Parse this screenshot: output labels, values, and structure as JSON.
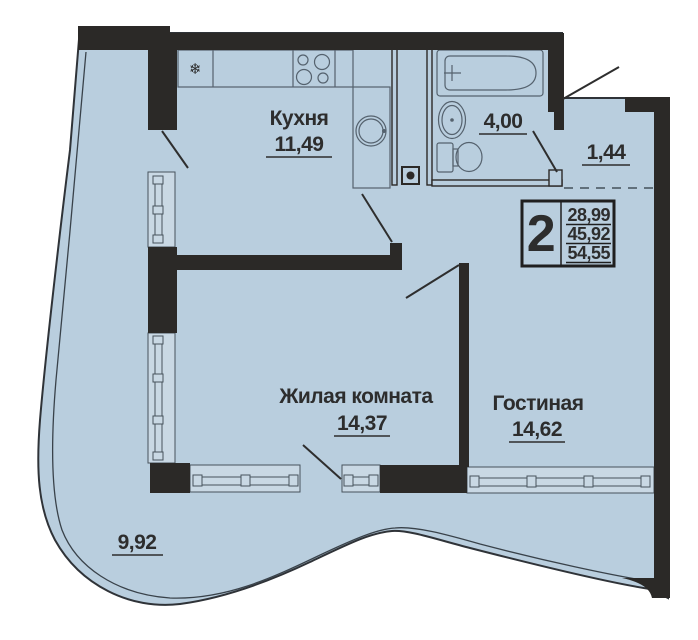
{
  "floor_plan": {
    "badge": {
      "room_count": "2",
      "area_values": [
        "28,99",
        "45,92",
        "54,55"
      ]
    },
    "rooms": {
      "kitchen": {
        "label": "Кухня",
        "area": "11,49"
      },
      "bathroom": {
        "area": "4,00"
      },
      "entry": {
        "area": "1,44"
      },
      "bedroom": {
        "label": "Жилая комната",
        "area": "14,37"
      },
      "lounge": {
        "label": "Гостиная",
        "area": "14,62"
      },
      "balcony": {
        "area": "9,92"
      }
    },
    "icons": {
      "fridge_snowflake": "❄"
    },
    "colors": {
      "floor": "#b9cede",
      "walls": "#2b2927",
      "fixture_lines": "#55626e",
      "text": "#2d2d2d"
    }
  }
}
